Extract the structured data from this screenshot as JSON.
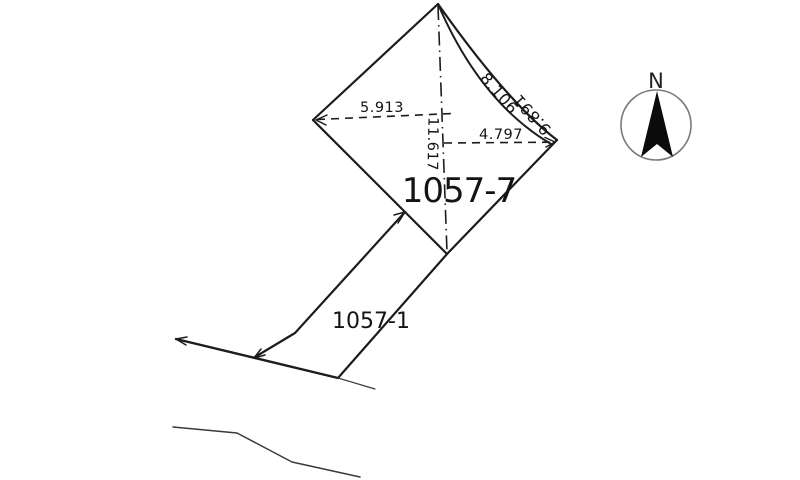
{
  "document_type": "cadastral-survey-plat",
  "colors": {
    "ink": "#1c1c1c",
    "paper": "#ffffff",
    "compass_ring": "#7a7a7a"
  },
  "parcels": {
    "main": {
      "label": "1057-7"
    },
    "access": {
      "label": "1057-1"
    }
  },
  "measurements": {
    "west_offset": "5.913",
    "east_offset": "4.797",
    "vertical_diagonal": "11.617",
    "ne_edge_inner": "8.106",
    "ne_edge_outer": "9.891"
  },
  "compass": {
    "north": "N"
  }
}
